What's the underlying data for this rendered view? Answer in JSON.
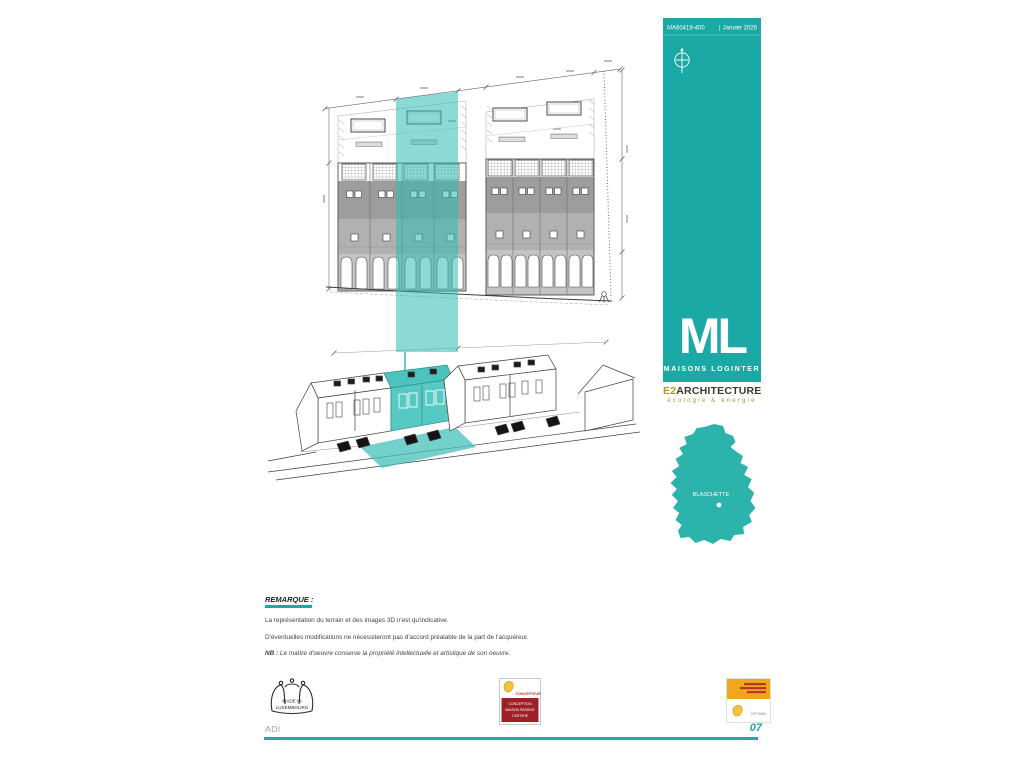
{
  "sheet": {
    "reference": "MA60419-400",
    "separator": "|",
    "date": "Janvier 2026"
  },
  "branding": {
    "logo_initials": "ML",
    "company": "MAISONS LOGINTER",
    "architect_prefix": "E2",
    "architect_name": "ARCHITECTURE",
    "architect_tagline": "écologie & énergie"
  },
  "map": {
    "location_label": "BLASCHETTE"
  },
  "remarks": {
    "title": "REMARQUE :",
    "line1": "La représentation du terrain et des images 3D n'est qu'indicative.",
    "line2": "D'éventuelles modifications ne nécessiteront pas d'accord préalable de la part de l'acquéreur.",
    "nb_prefix": "NB :",
    "nb_text": "Le maître d'oeuvre conserve la propriété intellectuelle et artistique de son oeuvre."
  },
  "badges": {
    "made_in_line1": "MADE IN",
    "made_in_line2": "LUXEMBOURG",
    "passive_role": "CONCEPTEUR",
    "passive_l1": "CONCEPTION",
    "passive_l2": "MAISON PASSIVE",
    "passive_l3": "CERTIFIÉ",
    "artisan_label": "ARTISAN"
  },
  "footer": {
    "initials": "ADI",
    "page_number": "07"
  },
  "colors": {
    "teal": "#1AA9A5",
    "teal_map": "#2BB3AC",
    "gold": "#AE982F",
    "dark": "#3C382F",
    "badge_red": "#9C2025",
    "badge_orange": "#F0A71C"
  }
}
